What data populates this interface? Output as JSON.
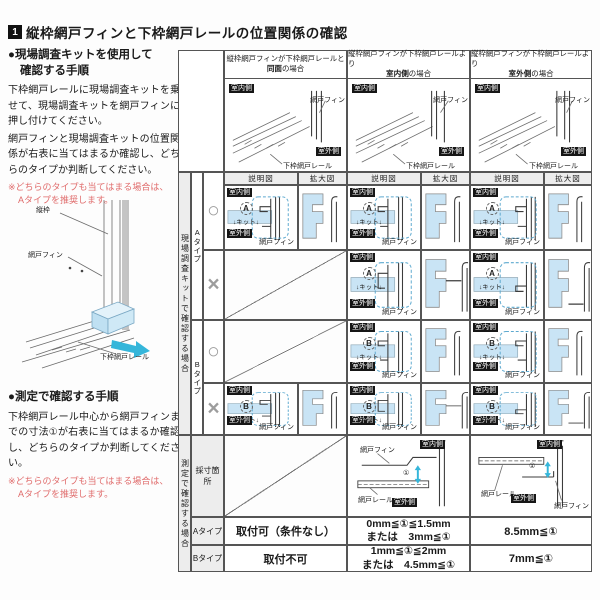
{
  "header": {
    "number": "1",
    "title": "縦枠網戸フィンと下枠網戸レールの位置関係の確認"
  },
  "left": {
    "kit": {
      "heading1": "●現場調査キットを使用して",
      "heading2": "確認する手順",
      "para1": "下枠網戸レールに現場調査キットを乗せて、現場調査キットを網戸フィンに押し付けてください。",
      "para2": "網戸フィンと現場調査キットの位置関係が右表に当てはまるか確認し、どちらのタイプか判断してください。",
      "note1": "※どちらのタイプも当てはまる場合は、",
      "note2": "Aタイプを推奨します。"
    },
    "measure": {
      "heading": "●測定で確認する手順",
      "para": "下枠網戸レール中心から網戸フィンまでの寸法①が右表に当てはまるか確認し、どちらのタイプか判断してください。",
      "note1": "※どちらのタイプも当てはまる場合は、",
      "note2": "Aタイプを推奨します。"
    }
  },
  "labels": {
    "indoor": "室内側",
    "outdoor": "室外側",
    "fin": "網戸フィン",
    "bottom_rail": "下枠網戸レール",
    "rail": "網戸レール",
    "tatewaku": "縦枠",
    "kit": "キット",
    "a": "A",
    "b": "B",
    "type_a": "Aタイプ",
    "type_b": "Bタイプ",
    "ok": "○",
    "ng": "×",
    "setsumei": "説明図",
    "kakudai": "拡大図",
    "dim": "①",
    "down": "↓"
  },
  "table": {
    "kit_sidebar": "現場調査キットで確認する場合",
    "measure_sidebar": "測定で確認する場合",
    "col_titles": [
      {
        "line1": "縦枠網戸フィンが下枠網戸レールと",
        "bold": "同面",
        "suffix": "の場合"
      },
      {
        "line1": "縦枠網戸フィンが下枠網戸レールより",
        "bold": "室内側",
        "suffix": "の場合"
      },
      {
        "line1": "縦枠網戸フィンが下枠網戸レールより",
        "bold": "室外側",
        "suffix": "の場合"
      }
    ],
    "saisun": "採寸箇所",
    "rows": {
      "a": {
        "label": "Aタイプ",
        "c1": "取付可（条件なし）",
        "c2l1": "0mm≦①≦1.5mm",
        "c2l2": "または　3mm≦①",
        "c3": "8.5mm≦①"
      },
      "b": {
        "label": "Bタイプ",
        "c1": "取付不可",
        "c2l1": "1mm≦①≦2mm",
        "c2l2": "または　4.5mm≦①",
        "c3": "7mm≦①"
      }
    }
  },
  "colors": {
    "kit_blue": "#c9e4f5",
    "arrow_cyan": "#35b6da",
    "note_red": "#e06c6c"
  }
}
